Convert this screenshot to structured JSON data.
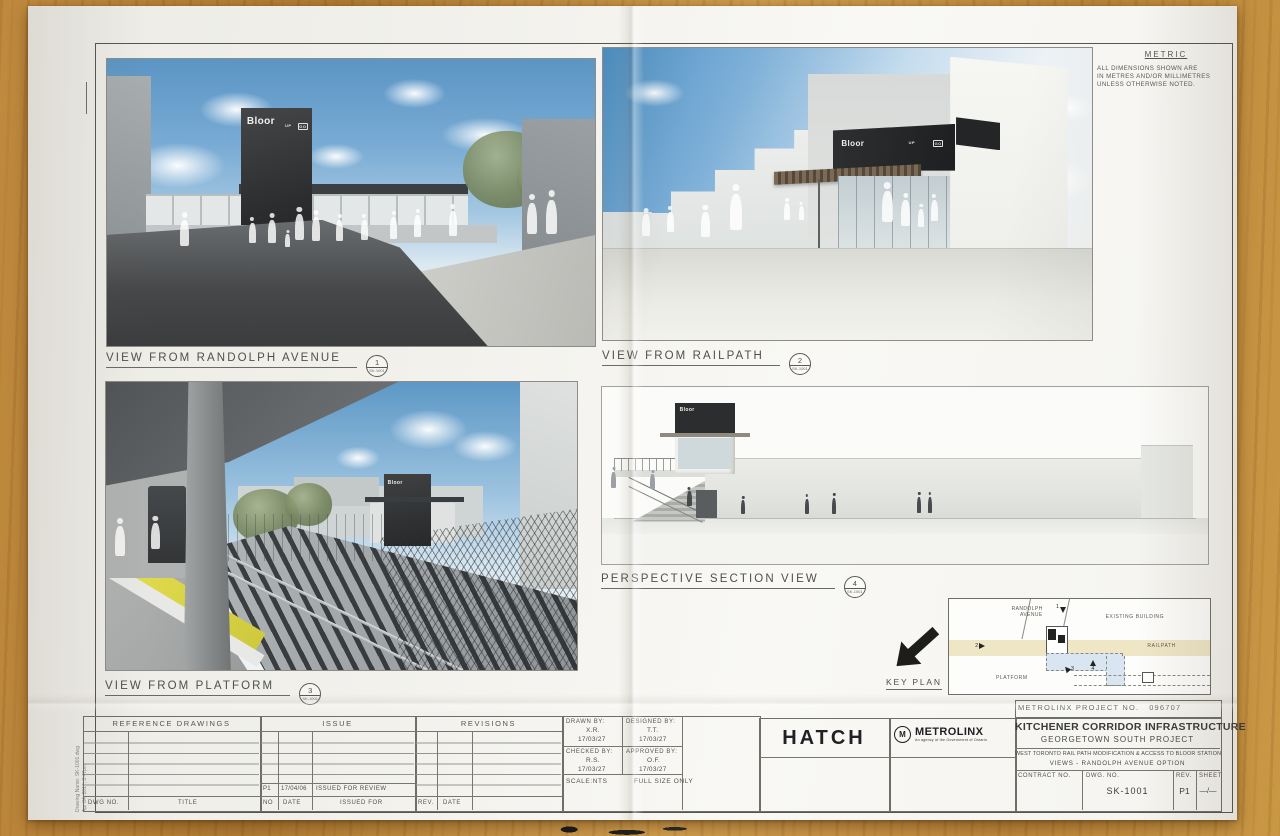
{
  "sheet": {
    "metric": {
      "title": "METRIC",
      "line1": "ALL DIMENSIONS SHOWN ARE",
      "line2": "IN METRES AND/OR MILLIMETRES",
      "line3": "UNLESS OTHERWISE NOTED."
    },
    "station_sign": {
      "name": "Bloor",
      "up": "UP",
      "go": "GO"
    },
    "views": [
      {
        "title": "VIEW FROM RANDOLPH AVENUE",
        "num": "1",
        "ref": "SK-1001"
      },
      {
        "title": "VIEW FROM RAILPATH",
        "num": "2",
        "ref": "SK-1001"
      },
      {
        "title": "VIEW FROM PLATFORM",
        "num": "3",
        "ref": "SK-1001"
      },
      {
        "title": "PERSPECTIVE SECTION VIEW",
        "num": "4",
        "ref": "SK-1001"
      }
    ],
    "key_plan": {
      "title": "KEY PLAN",
      "randolph_line1": "RANDOLPH",
      "randolph_line2": "AVENUE",
      "existing_building": "EXISTING BUILDING",
      "railpath": "RAILPATH",
      "platform": "PLATFORM",
      "m1": "1",
      "m2": "2",
      "m3": "3",
      "m4": "4"
    },
    "ref_table": {
      "header": "REFERENCE DRAWINGS",
      "col_dwg": "DWG NO.",
      "col_title": "TITLE"
    },
    "issue_table": {
      "header": "ISSUE",
      "col_no": "NO",
      "col_date": "DATE",
      "col_for": "ISSUED FOR",
      "row_no": "P1",
      "row_date": "17/04/06",
      "row_for": "ISSUED FOR REVIEW"
    },
    "rev_table": {
      "header": "REVISIONS",
      "col_rev": "REV.",
      "col_date": "DATE"
    },
    "admin": {
      "drawn_label": "DRAWN BY:",
      "drawn": "X.R.",
      "drawn_date": "17/03/27",
      "designed_label": "DESIGNED BY:",
      "designed": "T.T.",
      "designed_date": "17/03/27",
      "checked_label": "CHECKED BY:",
      "checked": "R.S.",
      "checked_date": "17/03/27",
      "approved_label": "APPROVED BY:",
      "approved": "O.F.",
      "approved_date": "17/03/27",
      "scale": "SCALE:NTS",
      "full_size": "FULL SIZE ONLY"
    },
    "title_block": {
      "company": "HATCH",
      "agency": "METROLINX",
      "agency_m": "M",
      "agency_sub": "An agency of the Government of Ontario",
      "project_no_label": "METROLINX PROJECT NO.",
      "project_no_value": "096707",
      "title": "KITCHENER CORRIDOR INFRASTRUCTURE",
      "subtitle": "GEORGETOWN SOUTH PROJECT",
      "desc1": "WEST TORONTO RAIL PATH MODIFICATION & ACCESS TO BLOOR STATION",
      "desc2": "VIEWS - RANDOLPH AVENUE OPTION",
      "contract_label": "CONTRACT NO.",
      "dwg_label": "DWG. NO.",
      "dwg_value": "SK-1001",
      "rev_label": "REV.",
      "rev_value": "P1",
      "sheet_label": "SHEET",
      "sheet_value": "—/—"
    },
    "plot_stamp": {
      "line1": "Apr 04, 2017, 3:47pm",
      "line2": "Drawing Name: SK-1001.dwg"
    },
    "colors": {
      "wood": "#c08a3e",
      "paper": "#f5f4f0",
      "sky": "#5b95c4",
      "sign_dark": "#2a2c2e",
      "tactile_yellow": "#ddd94a",
      "grass": "#6f8a3a",
      "railpath_band": "#efe6c6",
      "keyplan_path": "#d9e5f0"
    }
  }
}
